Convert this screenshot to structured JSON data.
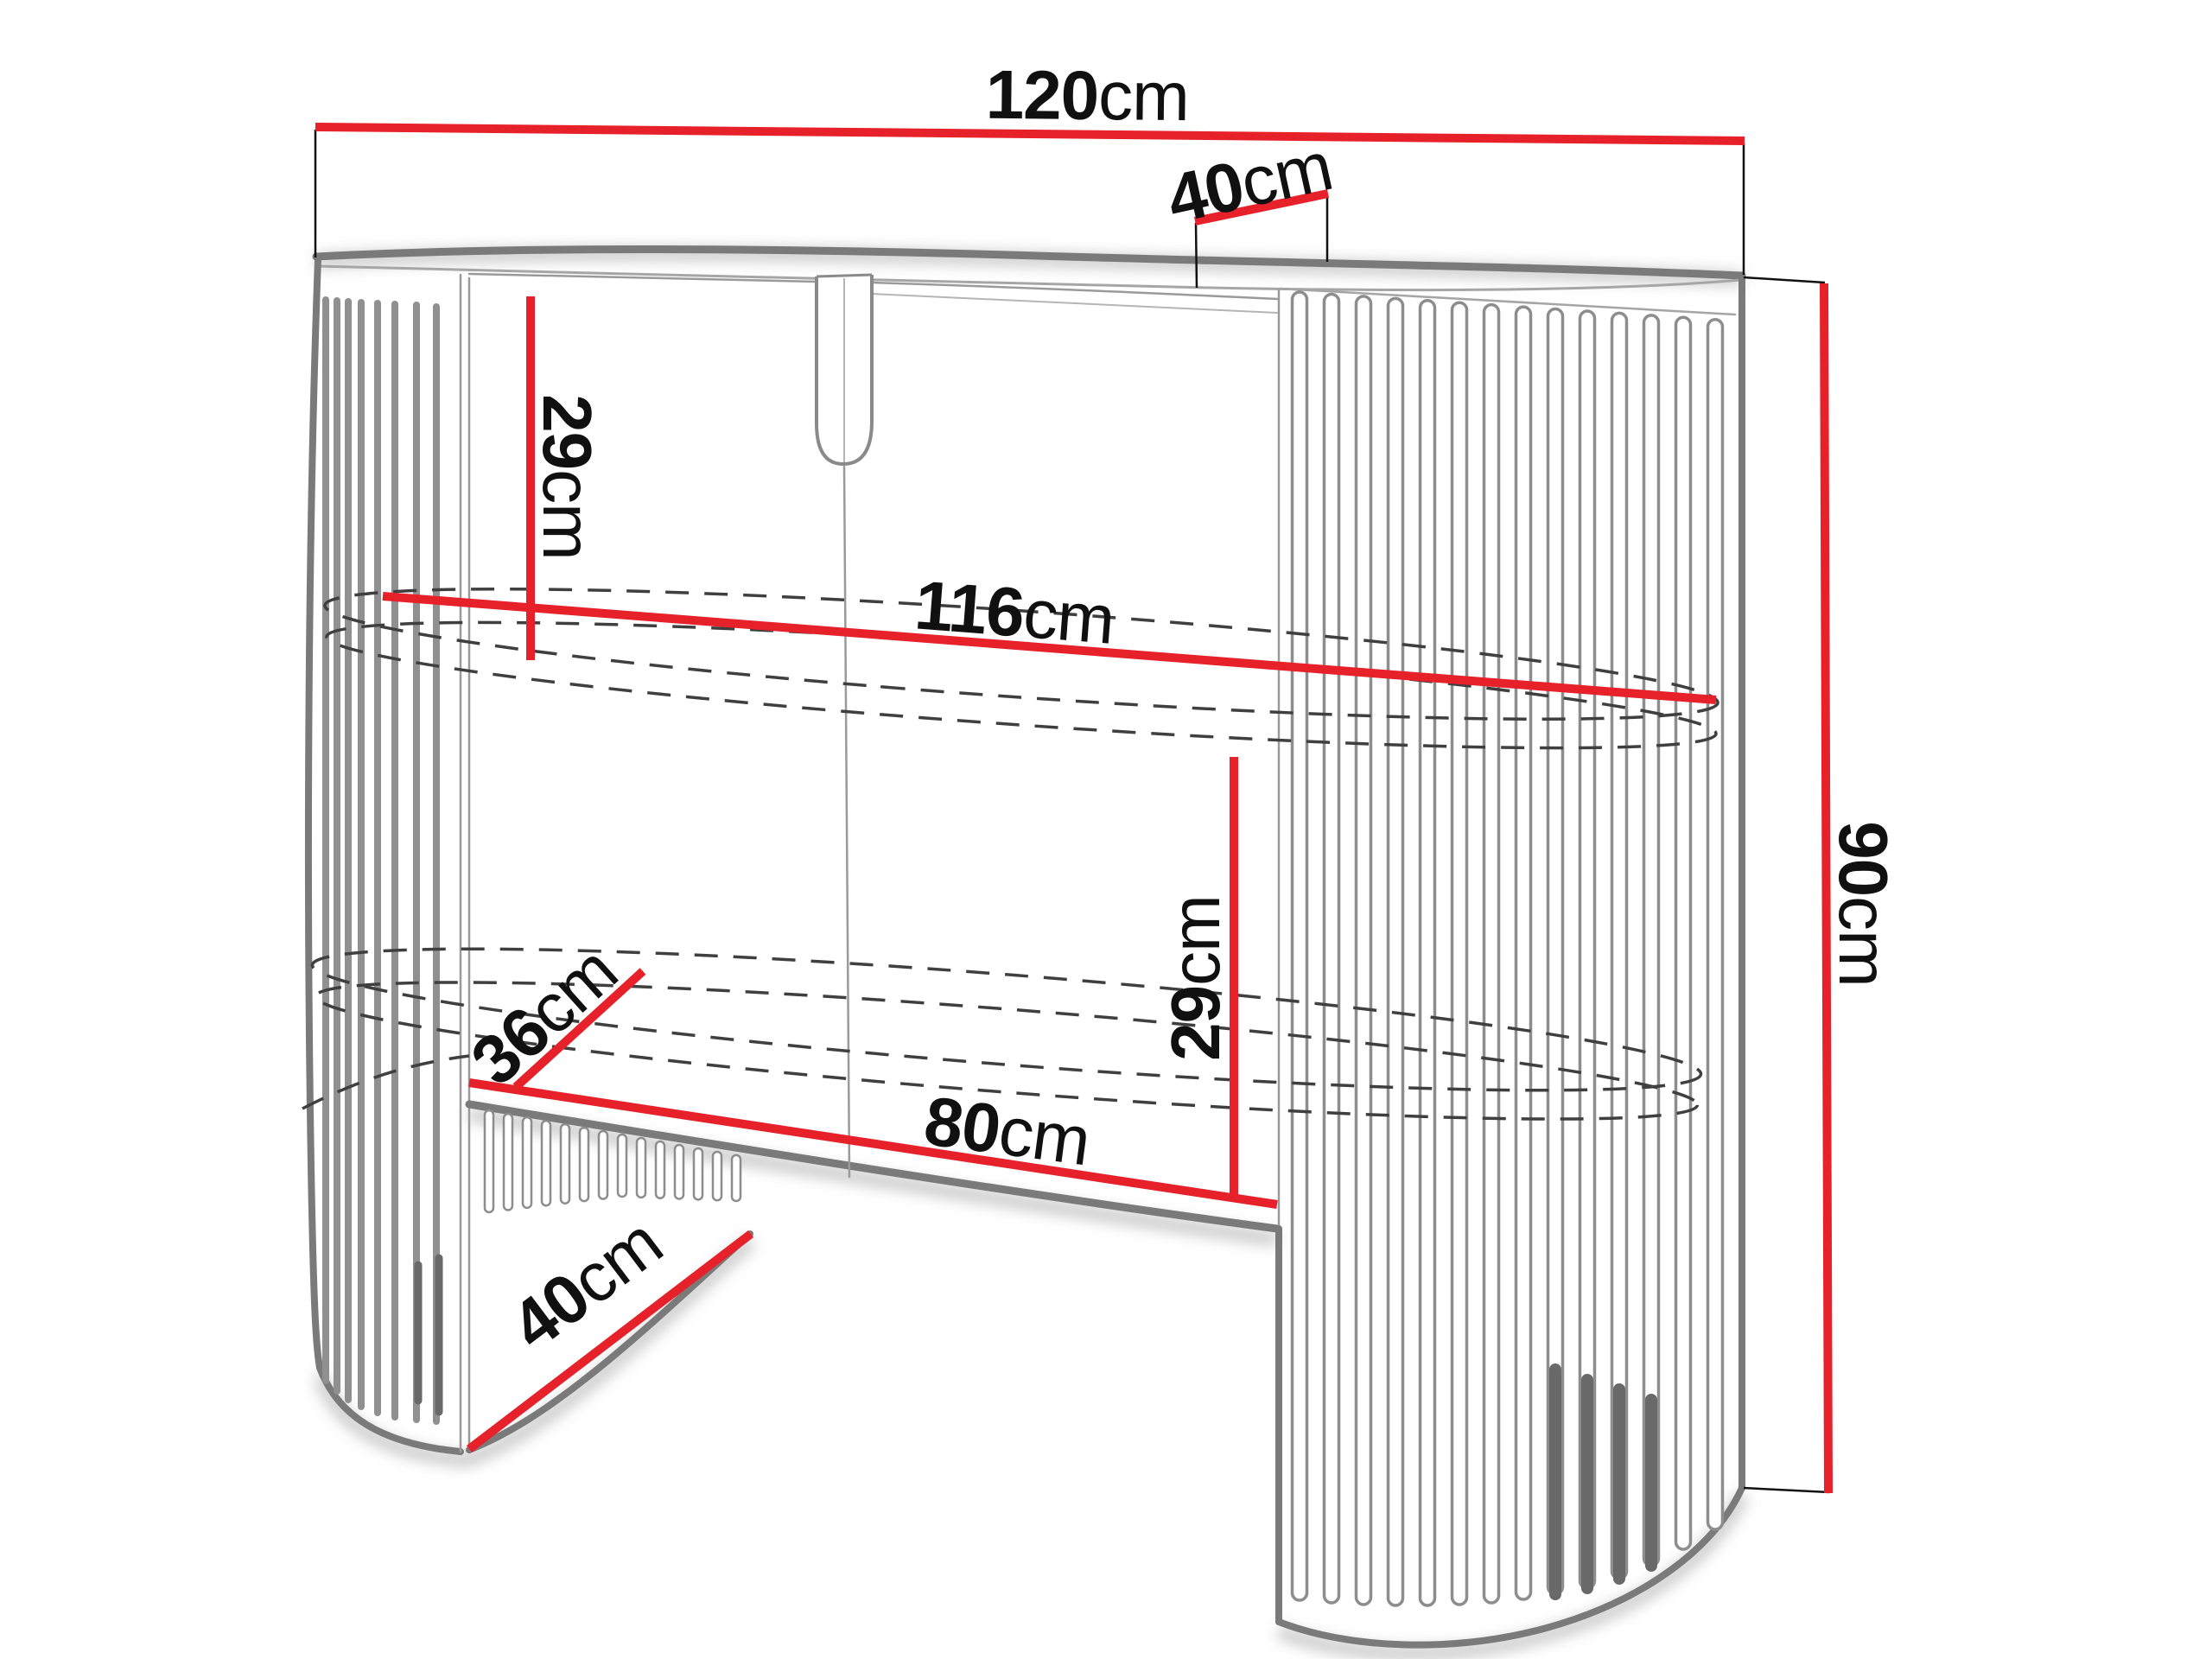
{
  "diagram": {
    "background": "#ffffff",
    "accent_red": "#e62129",
    "outline_grey": "#7a7a7a",
    "text_color": "#101010",
    "labels": {
      "total_width": {
        "value": "120",
        "unit": "cm"
      },
      "top_depth": {
        "value": "40",
        "unit": "cm"
      },
      "height": {
        "value": "90",
        "unit": "cm"
      },
      "inner_width": {
        "value": "116",
        "unit": "cm"
      },
      "top_to_shelf": {
        "value": "29",
        "unit": "cm"
      },
      "shelf_to_base": {
        "value": "29",
        "unit": "cm"
      },
      "base_depth": {
        "value": "36",
        "unit": "cm"
      },
      "base_width": {
        "value": "80",
        "unit": "cm"
      },
      "foot_depth": {
        "value": "40",
        "unit": "cm"
      }
    }
  }
}
